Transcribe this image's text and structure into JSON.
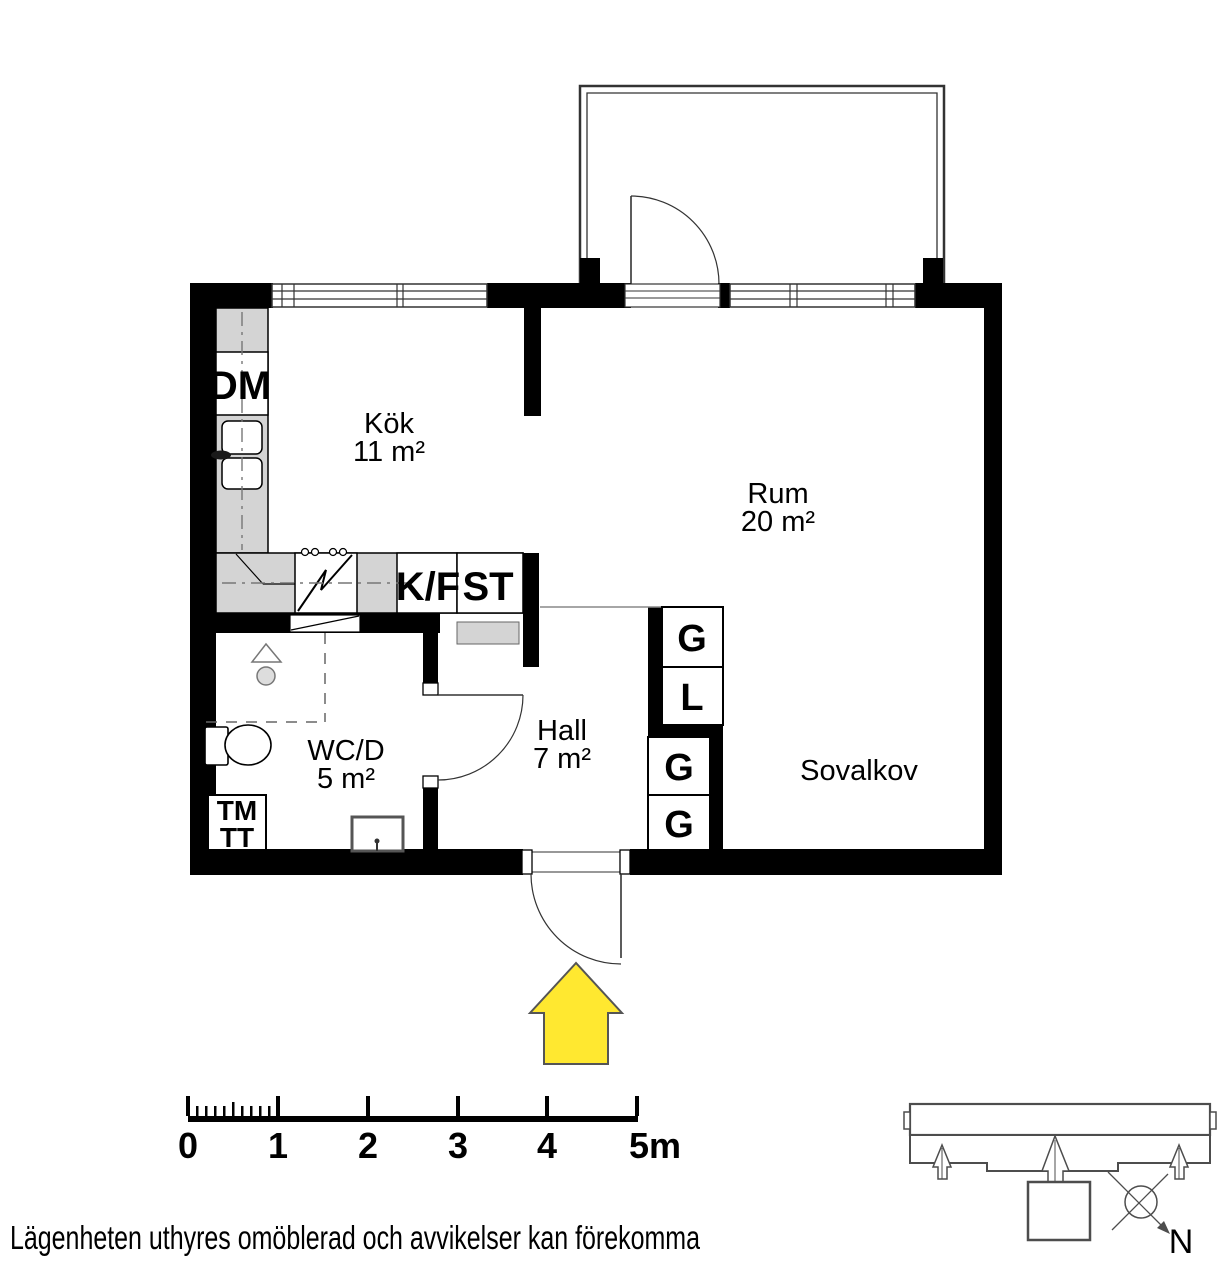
{
  "plan": {
    "rooms": {
      "kok": {
        "name": "Kök",
        "area": "11 m²"
      },
      "rum": {
        "name": "Rum",
        "area": "20 m²"
      },
      "wcd": {
        "name": "WC/D",
        "area": "5 m²"
      },
      "hall": {
        "name": "Hall",
        "area": "7 m²"
      },
      "sovalkov": {
        "name": "Sovalkov"
      }
    },
    "fixtures": {
      "dm": "DM",
      "kf": "K/F",
      "st": "ST",
      "wardrobes": [
        "G",
        "L",
        "G",
        "G"
      ],
      "tm": "TM",
      "tt": "TT"
    }
  },
  "scale_bar": {
    "labels": [
      "0",
      "1",
      "2",
      "3",
      "4",
      "5m"
    ]
  },
  "site_plan": {
    "north_label": "N"
  },
  "footer": {
    "disclaimer": "Lägenheten uthyres omöblerad och avvikelser kan förekomma"
  },
  "colors": {
    "wall": "#000000",
    "counter": "#d4d4d4",
    "entry_arrow": "#ffe830",
    "outline": "#4d4d4d"
  }
}
